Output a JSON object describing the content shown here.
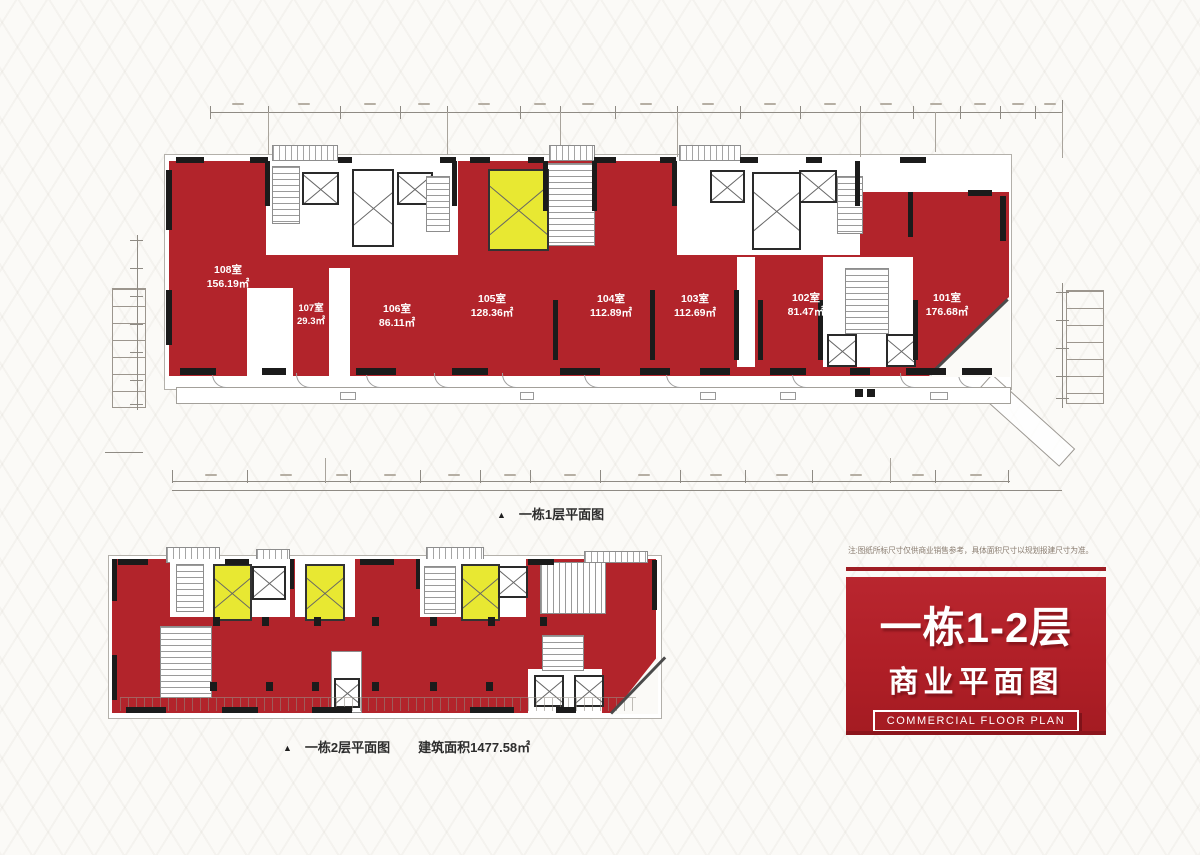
{
  "plan1": {
    "marker": "▲",
    "caption": "一栋1层平面图",
    "units": [
      {
        "id": "108室",
        "area": "156.19㎡"
      },
      {
        "id": "107室",
        "area": "29.3㎡"
      },
      {
        "id": "106室",
        "area": "86.11㎡"
      },
      {
        "id": "105室",
        "area": "128.36㎡"
      },
      {
        "id": "104室",
        "area": "112.89㎡"
      },
      {
        "id": "103室",
        "area": "112.69㎡"
      },
      {
        "id": "102室",
        "area": "81.47㎡"
      },
      {
        "id": "101室",
        "area": "176.68㎡"
      }
    ]
  },
  "plan2": {
    "marker": "▲",
    "caption": "一栋2层平面图",
    "area_note": "建筑面积1477.58㎡"
  },
  "aside": {
    "disclaimer": "注:图纸所标尺寸仅供商业销售参考，具体面积尺寸以规划报建尺寸为准。",
    "banner_title": "一栋1-2层",
    "banner_subtitle": "商业平面图",
    "banner_caption": "COMMERCIAL FLOOR PLAN"
  },
  "colors": {
    "unit_red": "#b2242b",
    "highlight_yellow": "#e8e832",
    "banner_red": "#b01f27",
    "wall_black": "#1b1b1b"
  }
}
